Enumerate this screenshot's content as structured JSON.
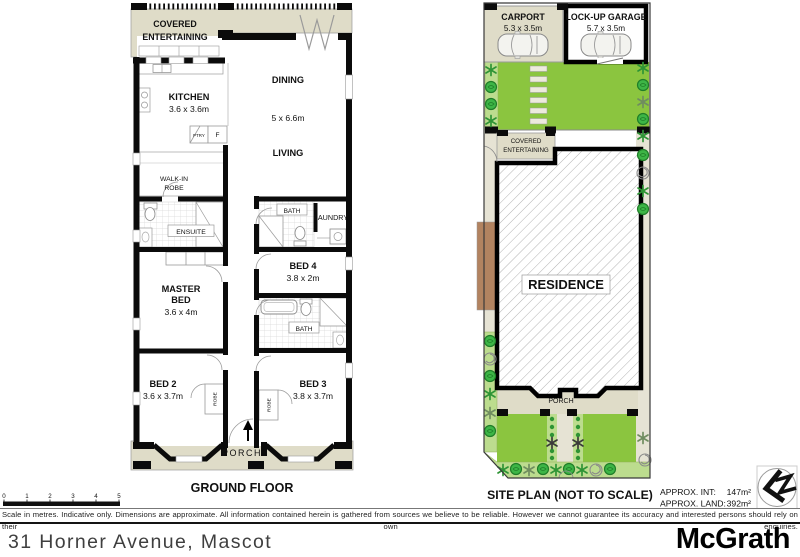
{
  "page": {
    "address": "31 Horner Avenue, Mascot",
    "brand": "McGrath",
    "disclaimer": "Scale in metres. Indicative only. Dimensions are approximate. All information contained herein is gathered from sources we believe to be reliable. However we cannot guarantee its accuracy and interested persons should rely on their own enquiries."
  },
  "colors": {
    "lawn": "#8bc53f",
    "garden_bed": "#bcdc8e",
    "plant": "#3db546",
    "paving": "#dfdcc8",
    "walkway": "#e6e3d4",
    "timber": "#b28360",
    "wall": "#0b0b0b"
  },
  "scale_bar": {
    "labels": [
      "0",
      "1",
      "2",
      "3",
      "4",
      "5"
    ]
  },
  "floor_plan": {
    "title": "GROUND FLOOR",
    "covered_entertaining": {
      "line1": "COVERED",
      "line2": "ENTERTAINING"
    },
    "kitchen": {
      "name": "KITCHEN",
      "dims": "3.6 x 3.6m"
    },
    "pantry": "PTRY",
    "fridge": "F",
    "dining": "DINING",
    "open_plan_dims": "5 x 6.6m",
    "living": "LIVING",
    "walk_in_robe": {
      "line1": "WALK-IN",
      "line2": "ROBE"
    },
    "ensuite": "ENSUITE",
    "bath_top": "BATH",
    "laundry": "LAUNDRY",
    "bed4": {
      "name": "BED 4",
      "dims": "3.8 x 2m"
    },
    "master": {
      "line1": "MASTER",
      "line2": "BED",
      "dims": "3.6 x 4m"
    },
    "bath_mid": "BATH",
    "bed2": {
      "name": "BED 2",
      "dims": "3.6 x 3.7m"
    },
    "bed3": {
      "name": "BED 3",
      "dims": "3.8 x 3.7m"
    },
    "robe_left": "ROBE",
    "robe_right": "ROBE",
    "porch": "PORCH"
  },
  "site_plan": {
    "title": "SITE PLAN (NOT TO SCALE)",
    "carport": {
      "name": "CARPORT",
      "dims": "5.3 x 3.5m"
    },
    "garage": {
      "name": "LOCK-UP GARAGE",
      "dims": "5.7 x 3.5m"
    },
    "covered_entertaining": {
      "line1": "COVERED",
      "line2": "ENTERTAINING"
    },
    "residence": "RESIDENCE",
    "porch": "PORCH",
    "areas": {
      "int_label": "APPROX. INT:",
      "int_value": "147m²",
      "land_label": "APPROX. LAND:",
      "land_value": "392m²"
    }
  }
}
